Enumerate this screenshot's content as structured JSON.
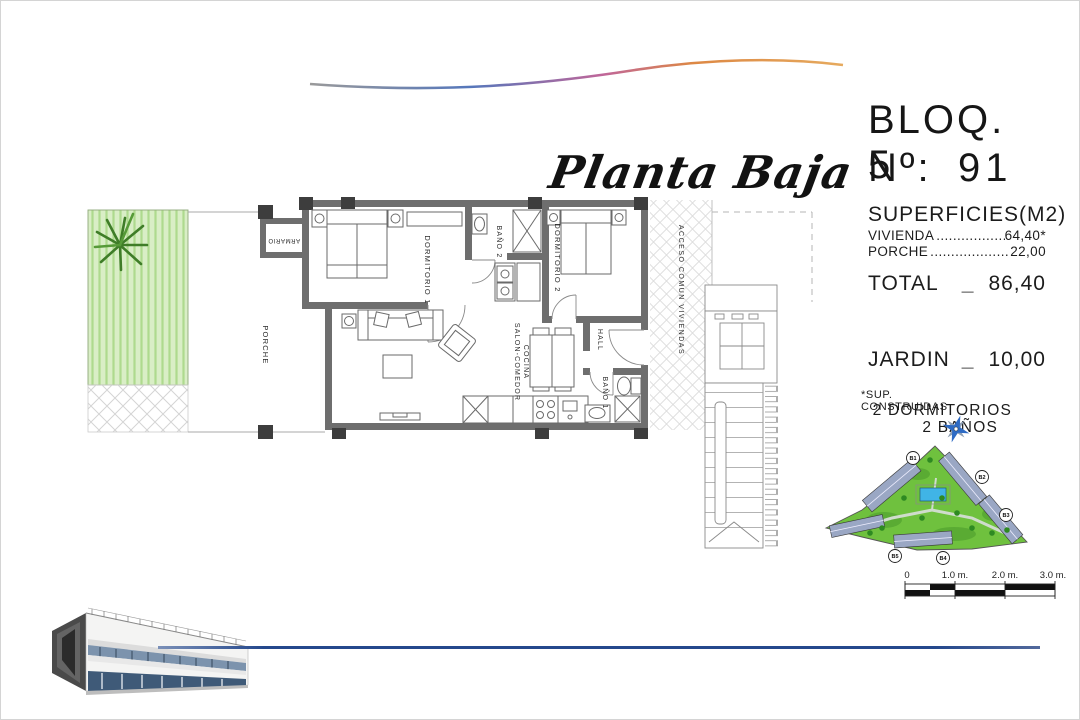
{
  "title": {
    "text": "Planta Baja"
  },
  "info": {
    "block": "BLOQ. 5",
    "unit_label": "Nº:",
    "unit_number": "91",
    "surfaces_title": "SUPERFICIES(M2)",
    "surface_rows": [
      {
        "label": "VIVIENDA",
        "dots": "..........................",
        "value": "64,40*"
      },
      {
        "label": "PORCHE",
        "dots": "..........................",
        "value": "22,00"
      }
    ],
    "total_label": "TOTAL",
    "total_sep": "_",
    "total_value": "86,40",
    "jardin_label": "JARDIN",
    "jardin_sep": "_",
    "jardin_value": "10,00",
    "footnote": "*SUP. CONSTRUIDAS",
    "feature_1": "2 DORMITORIOS",
    "feature_2": "2 BAÑOS"
  },
  "floor_plan": {
    "labels": {
      "porche": "PORCHE",
      "armario": "ARMARIO",
      "dormitorio1": "DORMITORIO 1",
      "bano2": "BAÑO 2",
      "dormitorio2": "DORMITORIO 2",
      "hall": "HALL",
      "bano1": "BAÑO 1",
      "salon_line1": "SALON-COMEDOR",
      "salon_line2": "COCINA",
      "acceso": "ACCESO COMUN VIVIENDAS"
    }
  },
  "site_plan": {
    "block_labels": [
      "B1",
      "B2",
      "B3",
      "B4",
      "B5"
    ]
  },
  "scale_bar": {
    "tick_labels": [
      "0",
      "1.0 m.",
      "2.0 m.",
      "3.0 m."
    ]
  },
  "colors": {
    "garden_green": "#d9eec6",
    "site_green": "#6fc13e",
    "pool_blue": "#40b4e6",
    "wall_gray": "#6e6e6e",
    "accent_blue_line": "#24488c"
  }
}
